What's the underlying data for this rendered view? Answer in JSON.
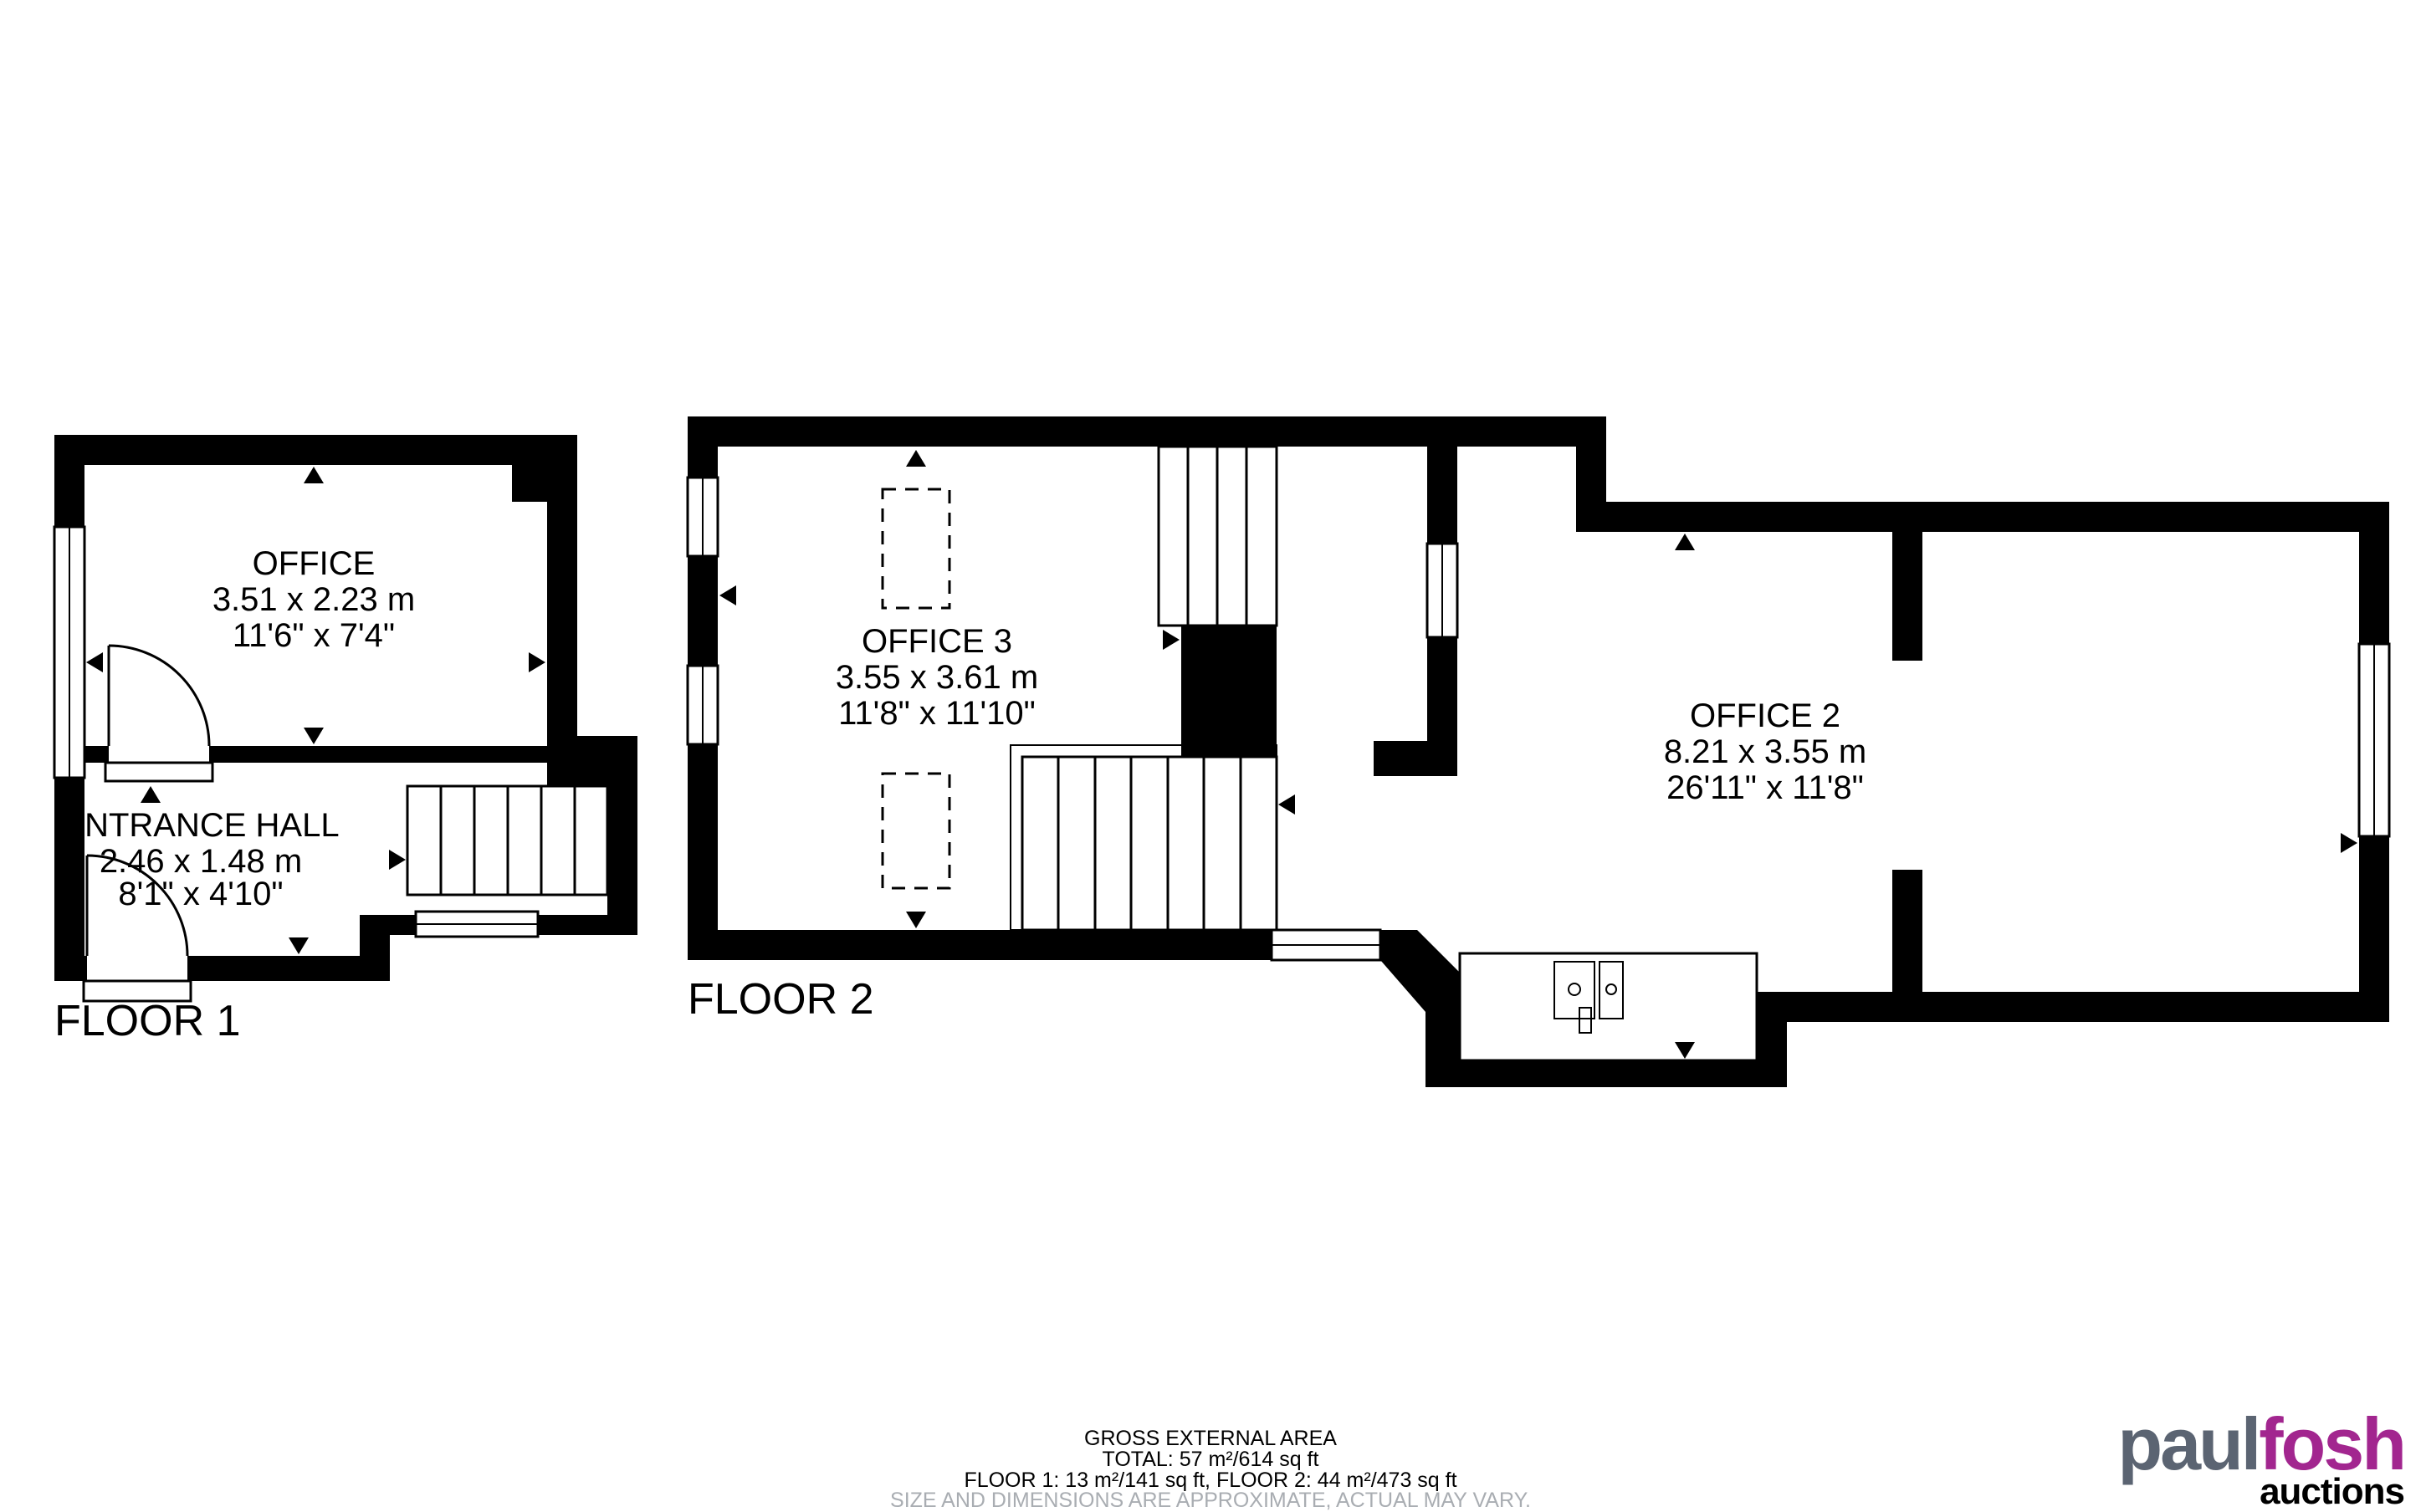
{
  "page": {
    "background": "#ffffff"
  },
  "floor1": {
    "label": "FLOOR 1",
    "office": {
      "name": "OFFICE",
      "size_metric": "3.51 x 2.23 m",
      "size_imperial": "11'6\" x 7'4\""
    },
    "entrance_hall": {
      "name": "ENTRANCE HALL",
      "size_metric": "2.46 x 1.48 m",
      "size_imperial": "8'1\" x 4'10\""
    }
  },
  "floor2": {
    "label": "FLOOR 2",
    "office3": {
      "name": "OFFICE 3",
      "size_metric": "3.55 x 3.61 m",
      "size_imperial": "11'8\" x 11'10\""
    },
    "office2": {
      "name": "OFFICE 2",
      "size_metric": "8.21 x 3.55 m",
      "size_imperial": "26'11\" x 11'8\""
    }
  },
  "summary": {
    "title": "GROSS EXTERNAL AREA",
    "total": "TOTAL: 57 m²/614 sq ft",
    "floors": "FLOOR 1: 13 m²/141 sq ft, FLOOR 2: 44 m²/473 sq ft",
    "disclaimer": "SIZE AND DIMENSIONS ARE APPROXIMATE, ACTUAL MAY VARY."
  },
  "logo": {
    "part1": "paul",
    "part2": "fosh",
    "tagline": "auctions"
  },
  "colors": {
    "wall": "#000000",
    "logo_gray": "#5b6472",
    "logo_purple": "#a2268f",
    "disclaimer_gray": "#a9adb2"
  }
}
